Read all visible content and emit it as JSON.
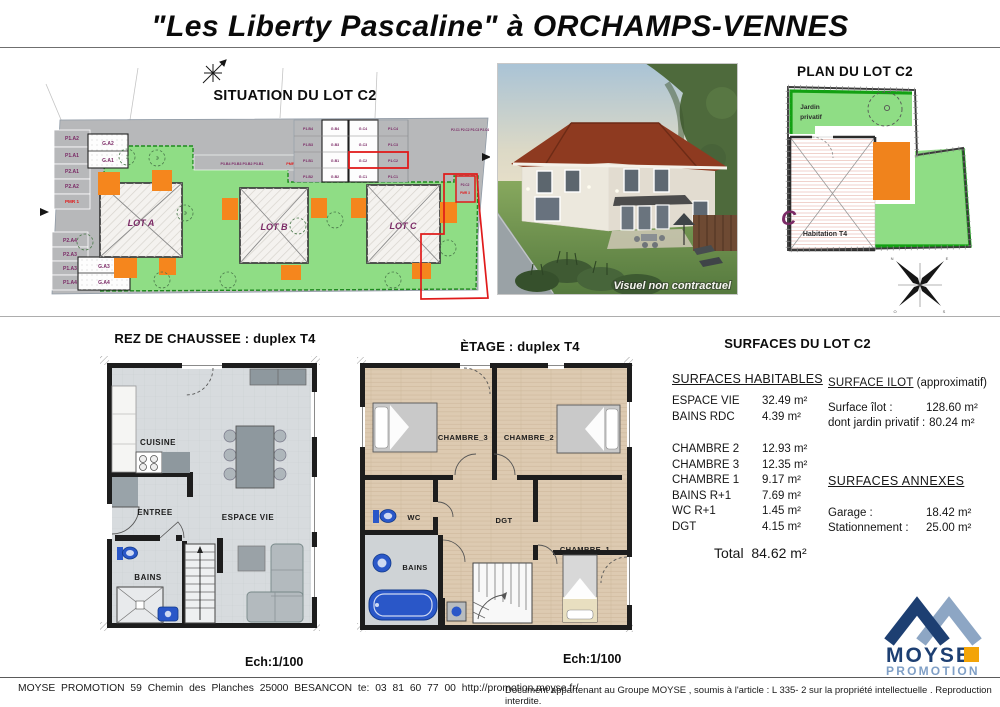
{
  "page": {
    "title": "\"Les Liberty Pascaline\" à ORCHAMPS-VENNES"
  },
  "situation": {
    "title": "SITUATION DU LOT C2",
    "lots": [
      "LOT A",
      "LOT B",
      "LOT C"
    ],
    "left_top": [
      "P1.A2",
      "P1.A1",
      "P2.A1",
      "P2.A2"
    ],
    "pmr1": "PMR 1",
    "left_bottom": [
      "P2.A4",
      "P2.A3",
      "P1.A3",
      "P1.A4"
    ],
    "garage_top": [
      "G.A2",
      "G.A1"
    ],
    "garage_bottom": [
      "G.A3",
      "G.A4"
    ],
    "grid": {
      "r1": [
        "P1.B4",
        "G.B4",
        "G.C4",
        "P1.C4"
      ],
      "r2": [
        "P1.B3",
        "G.B3",
        "G.C3",
        "P1.C3"
      ],
      "r3": [
        "P1.B1",
        "G.B1",
        "G.C2",
        "P1.C2"
      ],
      "r4": [
        "P1.B2",
        "G.B2",
        "G.C1",
        "P1.C1"
      ]
    },
    "strip_b": "P3.B4 P3.B3 P3.B2 P3.B1",
    "pmr2": "PMR 2",
    "p2c_row": "P2.C1 P2.C2 P2.C3 P2.C4",
    "c2_stall": "P2.C2",
    "pmr3": "PMR 3"
  },
  "photo": {
    "caption": "Visuel non contractuel"
  },
  "plan_c2": {
    "title": "PLAN DU LOT C2",
    "jardin1": "Jardin",
    "jardin2": "privatif",
    "habitation": "Habitation T4",
    "letter": "C"
  },
  "rdc": {
    "title": "REZ DE CHAUSSEE : duplex T4",
    "rooms": {
      "cuisine": "CUISINE",
      "entree": "ENTREE",
      "espace_vie": "ESPACE VIE",
      "bains": "BAINS"
    },
    "scale": "Ech:1/100"
  },
  "etage": {
    "title": "ÈTAGE : duplex T4",
    "rooms": {
      "chambre3": "CHAMBRE_3",
      "chambre2": "CHAMBRE_2",
      "chambre1": "CHAMBRE_1",
      "wc": "WC",
      "dgt": "DGT",
      "bains": "BAINS"
    },
    "scale": "Ech:1/100"
  },
  "surfaces": {
    "title": "SURFACES DU LOT C2",
    "habitables": {
      "header": "SURFACES HABITABLES",
      "rows": [
        {
          "label": "ESPACE VIE",
          "value": "32.49 m²"
        },
        {
          "label": "BAINS RDC",
          "value": "4.39 m²"
        },
        {
          "label": "CHAMBRE 2",
          "value": "12.93 m²"
        },
        {
          "label": "CHAMBRE 3",
          "value": "12.35 m²"
        },
        {
          "label": "CHAMBRE 1",
          "value": "9.17 m²"
        },
        {
          "label": "BAINS R+1",
          "value": "7.69 m²"
        },
        {
          "label": "WC R+1",
          "value": "1.45 m²"
        },
        {
          "label": "DGT",
          "value": "4.15 m²"
        }
      ],
      "total_label": "Total",
      "total_value": "84.62 m²"
    },
    "ilot": {
      "header": "SURFACE ILOT",
      "header_suffix": " (approximatif)",
      "rows": [
        {
          "label": "Surface îlot :",
          "value": "128.60 m²"
        },
        {
          "label": "dont jardin privatif :",
          "value": "80.24 m²"
        }
      ]
    },
    "annexes": {
      "header": "SURFACES ANNEXES",
      "rows": [
        {
          "label": "Garage :",
          "value": "18.42 m²"
        },
        {
          "label": "Stationnement :",
          "value": "25.00 m²"
        }
      ]
    }
  },
  "footer": {
    "left": "MOYSE PROMOTION 59 Chemin des Planches 25000 BESANCON te: 03 81 60 77 00 http://promotion.moyse.fr/",
    "right": "Document appartenant au Groupe MOYSE , soumis à l'article : L 335- 2 sur la propriété intellectuelle . Reproduction interdite.",
    "logo_name": "MOYSE",
    "logo_sub": "PROMOTION",
    "brand_navy": "#1d3f72",
    "brand_steel": "#8da6c4",
    "brand_orange": "#f3a408"
  }
}
